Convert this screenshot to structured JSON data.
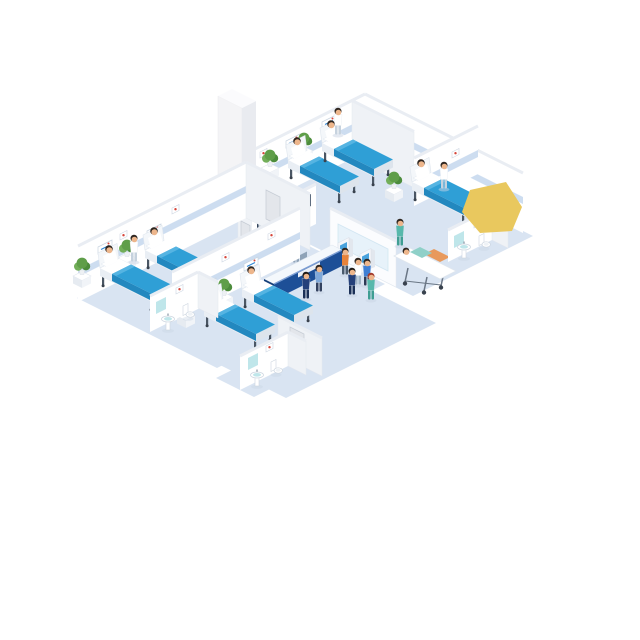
{
  "scene": {
    "title": "Hospital Ward Isometric Illustration",
    "description": "Isometric cutaway illustration of a hospital ward floor: four patient rooms with beds and plants, a nurses reception desk with wall monitors, two self-service kiosks, an elevator shaft, three small bathrooms with sinks and toilets, a patient on a stretcher, and staff, patients and visitors walking the corridors.",
    "summary": {
      "patient_rooms": 4,
      "hospital_beds": 7,
      "stretchers": 1,
      "patients": 8,
      "staff": 7,
      "visitors": 6,
      "plants": 7,
      "bathrooms": 3,
      "self_service_kiosks": 2,
      "wall_monitors": 3,
      "elevators": 1,
      "reception_desks": 1
    },
    "rooms": [
      {
        "name": "ward-room-top",
        "beds": 2,
        "patients": 2,
        "nurses": 1,
        "plants": 2
      },
      {
        "name": "ward-room-right",
        "beds": 1,
        "patients": 1,
        "nurses": 1,
        "plants": 1,
        "ensuite_bathroom": true
      },
      {
        "name": "ward-room-left",
        "beds": 2,
        "patients": 2,
        "nurses": 1,
        "plants": 2
      },
      {
        "name": "ward-room-bottom",
        "beds": 2,
        "patients": 2,
        "nurses": 0,
        "plants": 2
      }
    ],
    "lobby": {
      "reception_desk": 1,
      "receptionists": 1,
      "wall_monitors": 3,
      "self_service_kiosks": 2,
      "kiosk_users": 2,
      "elevator": 1
    },
    "corridor": {
      "stretcher_with_patient": 1,
      "st retcher_attendants": 1,
      "walking_nurses": 1,
      "doctor_with_visitor": 2,
      "walking_visitors": 2
    }
  },
  "palette": {
    "background": "#ffffff",
    "floor": "#d9e4f2",
    "wall": "#ffffff",
    "wall_shade": "#eff2f6",
    "wall_top": "#e9edf3",
    "wall_edge": "#e4e8ee",
    "rail_band": "#cdddf0",
    "bed_blanket": "#2f9fd6",
    "bed_blanket_dark": "#2388bf",
    "bed_blanket_light": "#55b4e2",
    "bed_frame": "#e9eef4",
    "bed_frame_dark": "#dde4ec",
    "metal": "#4a5664",
    "metal_dark": "#39424e",
    "plant": "#5f9e49",
    "plant_light": "#72ae59",
    "plant_dark": "#4c8c3c",
    "pot": "#eef1f4",
    "desk_blue": "#1d4f97",
    "desk_blue_dark": "#163f7a",
    "desk_top": "#f4f8fc",
    "desk_trim": "#7e9fd4",
    "screen_frame": "#32435a",
    "screen_blue": "#2f86d4",
    "screen_gray": "#cfd8e0",
    "kiosk_screen": "#4aa3dd",
    "glass_panel": "#e7f2fa",
    "teal": "#57b8ac",
    "teal_dark": "#3f9e93",
    "skin": "#edb68c",
    "hair_dark": "#2e2620",
    "hair_red": "#a23a2c",
    "hair_auburn": "#6e3326",
    "navy": "#24407a",
    "blue_light": "#7fa8d9",
    "blue_cloth": "#3f7fd4",
    "orange": "#e8833a",
    "gown": "#ffffff",
    "door": "#e3e6eb",
    "door_frame": "#c6ccd5",
    "sign_red": "#d6453a",
    "yellow": "#e9c85e",
    "fixture_teal": "#bfe6ea",
    "fixture_stroke": "#cdd6e0",
    "shadow": "#c9d4e4",
    "gurney_orange": "#e8995c"
  }
}
